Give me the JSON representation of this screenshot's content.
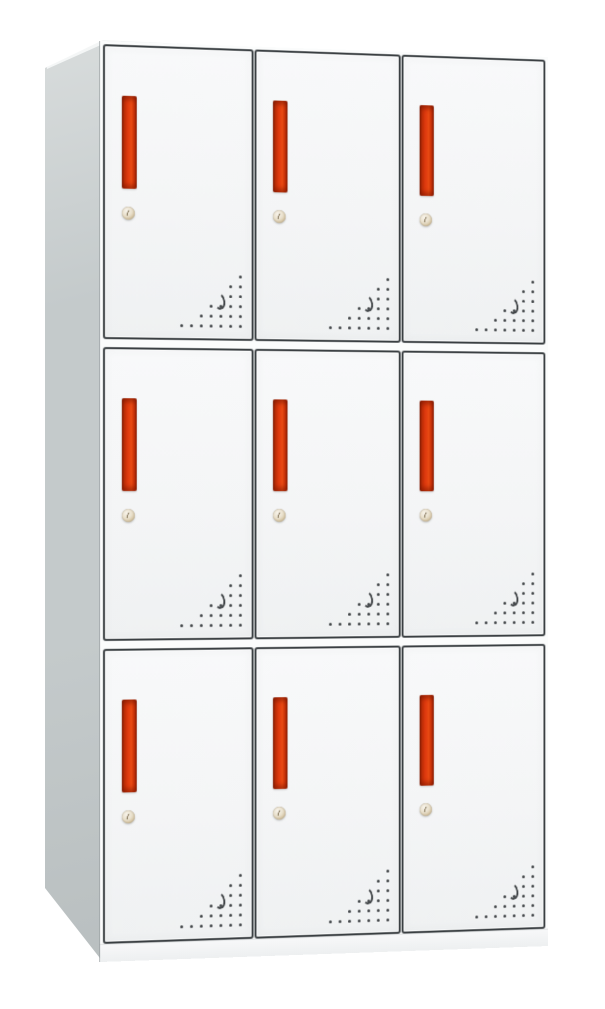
{
  "page": {
    "background": "#ffffff"
  },
  "cabinet": {
    "kind": "nine-door-steel-locker",
    "rows": 3,
    "columns": 3,
    "door_count": 9,
    "colors": {
      "background": "#ffffff",
      "frame_white": "#fbfcfc",
      "top_face": "#f4f6f6",
      "side_panel": "#c4cacb",
      "side_panel_light": "#d9dddd",
      "side_panel_dark": "#b9bfc0",
      "door_face": "#f4f5f6",
      "door_face_light": "#f8f9fa",
      "door_face_dark": "#eff1f2",
      "door_border": "#3a3f42",
      "handle_red": "#e03a0e",
      "handle_bright": "#e84a13",
      "handle_dark": "#8f2105",
      "handle_deep": "#9c2506",
      "lock_face": "#e8dfcb",
      "lock_rim": "#cfbd99",
      "vent_dot": "#3e4245",
      "plinth": "#f7f8f9"
    },
    "door": {
      "features": [
        "recessed-red-handle",
        "cam-lock-keyhole",
        "vent-hole-triangle"
      ],
      "vents": {
        "dot_spacing_px": 10,
        "dot_size_px": 3,
        "rows": [
          1,
          2,
          2,
          4,
          5,
          7
        ],
        "crescent": {
          "row": 2,
          "col": 2
        }
      }
    }
  }
}
